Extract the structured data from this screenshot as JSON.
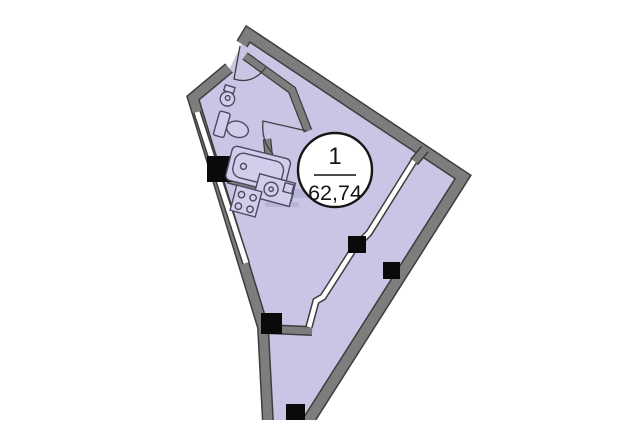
{
  "page": {
    "background_color": "#ffffff"
  },
  "plan": {
    "unit_label": {
      "number": "1",
      "area": "62,74"
    },
    "colors": {
      "floor": "#cac4e5",
      "wall": "#7d7d7d",
      "wall_dark": "#3d3d3d",
      "window_glass": "#ffffff",
      "column": "#0a0a0a",
      "fixture_line": "#4a4a60",
      "fixture_fill": "#d2cdeb",
      "door_line": "#3f3f3f",
      "label_bg": "#ffffff",
      "label_border": "#161616",
      "label_text": "#161616",
      "divider": "#333333",
      "watermark": "#8d96bb",
      "mask": "#ffffff"
    },
    "icons": [
      "entrance-door-arc-icon",
      "bathroom-door-arc-icon",
      "bathroom-sink-icon",
      "toilet-icon",
      "bathtub-icon",
      "kitchen-sink-icon",
      "stove-icon",
      "window-strip-left",
      "window-strip-southeast",
      "column-marker",
      "watermark-blur"
    ]
  }
}
